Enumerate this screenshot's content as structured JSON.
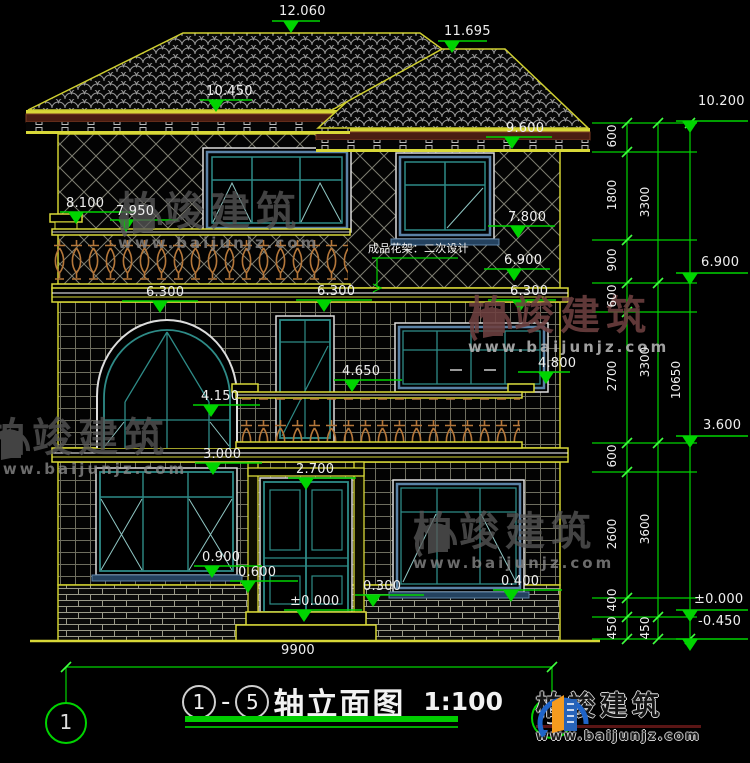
{
  "meta": {
    "axis_start": "1",
    "axis_end": "5",
    "separator": "-",
    "drawing_title": "轴立面图",
    "scale": "1:100",
    "total_width_dim": "9900"
  },
  "brand": {
    "name": "柏竣建筑",
    "url": "www.baijunjz.com"
  },
  "note": {
    "text": "成品花架：二次设计"
  },
  "colors": {
    "background": "#000000",
    "dimension_green": "#00d400",
    "line_yellow": "#d8d838",
    "frame_teal": "#2e8b87",
    "frame_blue": "#5b82a6",
    "baluster_orange": "#b5773a",
    "fascia_maroon": "#4a1d12",
    "text_white": "#efefef"
  },
  "elevation_markers": [
    {
      "name": "lvl-12060",
      "text": "12.060",
      "tx": 279,
      "ty": 5,
      "l": [
        272,
        320,
        21
      ],
      "ax": 291
    },
    {
      "name": "lvl-11695",
      "text": "11.695",
      "tx": 444,
      "ty": 25,
      "l": [
        438,
        487,
        41
      ],
      "ax": 452
    },
    {
      "name": "lvl-10450",
      "text": "10.450",
      "tx": 206,
      "ty": 85,
      "l": [
        200,
        252,
        100
      ],
      "ax": 216
    },
    {
      "name": "lvl-9600",
      "text": "9.600",
      "tx": 506,
      "ty": 122,
      "l": [
        486,
        552,
        137
      ],
      "ax": 512
    },
    {
      "name": "lvl-10200",
      "text": "10.200",
      "tx": 698,
      "ty": 95,
      "l": [
        676,
        748,
        121
      ],
      "ax": 690
    },
    {
      "name": "lvl-6900-right",
      "text": "6.900",
      "tx": 701,
      "ty": 256,
      "l": [
        676,
        748,
        273
      ],
      "ax": 690
    },
    {
      "name": "lvl-3600",
      "text": "3.600",
      "tx": 703,
      "ty": 419,
      "l": [
        676,
        748,
        436
      ],
      "ax": 690
    },
    {
      "name": "lvl-0000-right",
      "text": "±0.000",
      "tx": 694,
      "ty": 593,
      "l": [
        676,
        748,
        610
      ],
      "ax": 690
    },
    {
      "name": "lvl-minus0450",
      "text": "-0.450",
      "tx": 698,
      "ty": 615,
      "l": [
        676,
        748,
        639
      ],
      "ax": 690
    },
    {
      "name": "lvl-8100",
      "text": "8.100",
      "tx": 66,
      "ty": 197,
      "l": [
        60,
        136,
        212
      ],
      "ax": 76
    },
    {
      "name": "lvl-7950",
      "text": "7.950",
      "tx": 116,
      "ty": 205,
      "l": [
        110,
        178,
        220
      ],
      "ax": 126
    },
    {
      "name": "lvl-7800",
      "text": "7.800",
      "tx": 508,
      "ty": 211,
      "l": [
        488,
        555,
        226
      ],
      "ax": 518
    },
    {
      "name": "lvl-6900-mid",
      "text": "6.900",
      "tx": 504,
      "ty": 254,
      "l": [
        484,
        550,
        269
      ],
      "ax": 514
    },
    {
      "name": "lvl-6300-left",
      "text": "6.300",
      "tx": 146,
      "ty": 286,
      "l": [
        122,
        198,
        301
      ],
      "ax": 160
    },
    {
      "name": "lvl-6300-mid",
      "text": "6.300",
      "tx": 317,
      "ty": 285,
      "l": [
        296,
        372,
        300
      ],
      "ax": 324
    },
    {
      "name": "lvl-6300-right",
      "text": "6.300",
      "tx": 510,
      "ty": 285,
      "l": [
        488,
        556,
        300
      ],
      "ax": 520
    },
    {
      "name": "lvl-4650",
      "text": "4.650",
      "tx": 342,
      "ty": 365,
      "l": [
        334,
        402,
        380
      ],
      "ax": 352
    },
    {
      "name": "lvl-4800",
      "text": "4.800",
      "tx": 538,
      "ty": 357,
      "l": [
        518,
        570,
        372
      ],
      "ax": 546
    },
    {
      "name": "lvl-4150",
      "text": "4.150",
      "tx": 201,
      "ty": 390,
      "l": [
        193,
        260,
        405
      ],
      "ax": 211
    },
    {
      "name": "lvl-3000",
      "text": "3.000",
      "tx": 203,
      "ty": 448,
      "l": [
        195,
        262,
        463
      ],
      "ax": 213
    },
    {
      "name": "lvl-2700",
      "text": "2.700",
      "tx": 296,
      "ty": 463,
      "l": [
        288,
        356,
        478
      ],
      "ax": 306
    },
    {
      "name": "lvl-0900",
      "text": "0.900",
      "tx": 202,
      "ty": 551,
      "l": [
        194,
        262,
        566
      ],
      "ax": 212
    },
    {
      "name": "lvl-0600",
      "text": "0.600",
      "tx": 238,
      "ty": 566,
      "l": [
        230,
        298,
        581
      ],
      "ax": 248
    },
    {
      "name": "lvl-0300",
      "text": "0.300",
      "tx": 363,
      "ty": 580,
      "l": [
        355,
        424,
        595
      ],
      "ax": 373
    },
    {
      "name": "lvl-0400",
      "text": "0.400",
      "tx": 501,
      "ty": 575,
      "l": [
        493,
        562,
        590
      ],
      "ax": 511
    },
    {
      "name": "lvl-0000-mid",
      "text": "±0.000",
      "tx": 290,
      "ty": 595,
      "l": [
        284,
        362,
        610
      ],
      "ax": 304
    }
  ],
  "vertical_dims": [
    {
      "text": "600",
      "x": 612,
      "y": 137
    },
    {
      "text": "1800",
      "x": 612,
      "y": 196
    },
    {
      "text": "900",
      "x": 612,
      "y": 261
    },
    {
      "text": "600",
      "x": 612,
      "y": 297
    },
    {
      "text": "2700",
      "x": 612,
      "y": 377
    },
    {
      "text": "600",
      "x": 612,
      "y": 457
    },
    {
      "text": "2600",
      "x": 612,
      "y": 535
    },
    {
      "text": "400",
      "x": 612,
      "y": 601
    },
    {
      "text": "450",
      "x": 612,
      "y": 629
    },
    {
      "text": "3300",
      "x": 645,
      "y": 203
    },
    {
      "text": "3300",
      "x": 645,
      "y": 363
    },
    {
      "text": "3600",
      "x": 645,
      "y": 530
    },
    {
      "text": "450",
      "x": 645,
      "y": 629
    },
    {
      "text": "10650",
      "x": 676,
      "y": 381
    }
  ],
  "horizontal_dims": [
    {
      "text": "9900",
      "x": 281,
      "y": 644
    }
  ],
  "axis_bubbles": [
    {
      "text": "1",
      "x": 66,
      "y": 723
    },
    {
      "text": "5",
      "x": 552,
      "y": 718
    }
  ],
  "watermarks": [
    {
      "x": 118,
      "y": 192,
      "variant": "gray"
    },
    {
      "x": 468,
      "y": 296,
      "variant": "red"
    },
    {
      "x": -14,
      "y": 418,
      "variant": "gray"
    },
    {
      "x": 413,
      "y": 512,
      "variant": "gray"
    }
  ]
}
